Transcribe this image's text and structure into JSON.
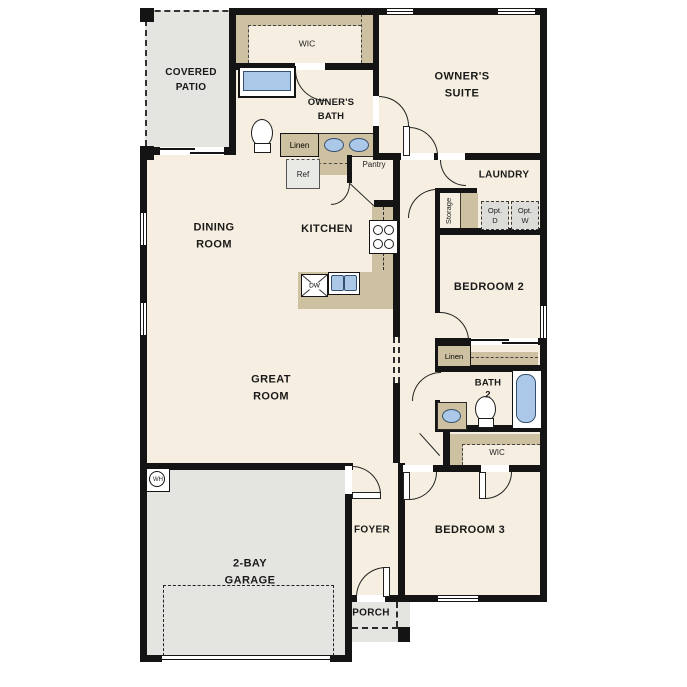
{
  "title": "Single-story floor plan",
  "colors": {
    "floor": "#f6efe1",
    "hardscape": "#e4e4e1",
    "cabinet": "#cdc1a1",
    "fixture_blue": "#abc8e8",
    "wall": "#141414"
  },
  "rooms": {
    "covered_patio": "COVERED\nPATIO",
    "owners_wic": "WIC",
    "owners_bath": "OWNER'S\nBATH",
    "owners_suite": "OWNER'S\nSUITE",
    "laundry": "LAUNDRY",
    "dining_room": "DINING\nROOM",
    "kitchen": "KITCHEN",
    "bedroom_2": "BEDROOM 2",
    "great_room": "GREAT\nROOM",
    "bath_2": "BATH\n2",
    "bed3_wic": "WIC",
    "garage": "2-BAY\nGARAGE",
    "foyer": "FOYER",
    "bedroom_3": "BEDROOM 3",
    "porch": "PORCH"
  },
  "fixtures": {
    "linen_bath": "Linen",
    "ref": "Ref",
    "pantry": "Pantry",
    "storage": "Storage",
    "opt_dryer": "Opt.\nD",
    "opt_washer": "Opt.\nW",
    "linen_hall": "Linen",
    "dishwasher": "DW",
    "water_heater": "WH"
  }
}
